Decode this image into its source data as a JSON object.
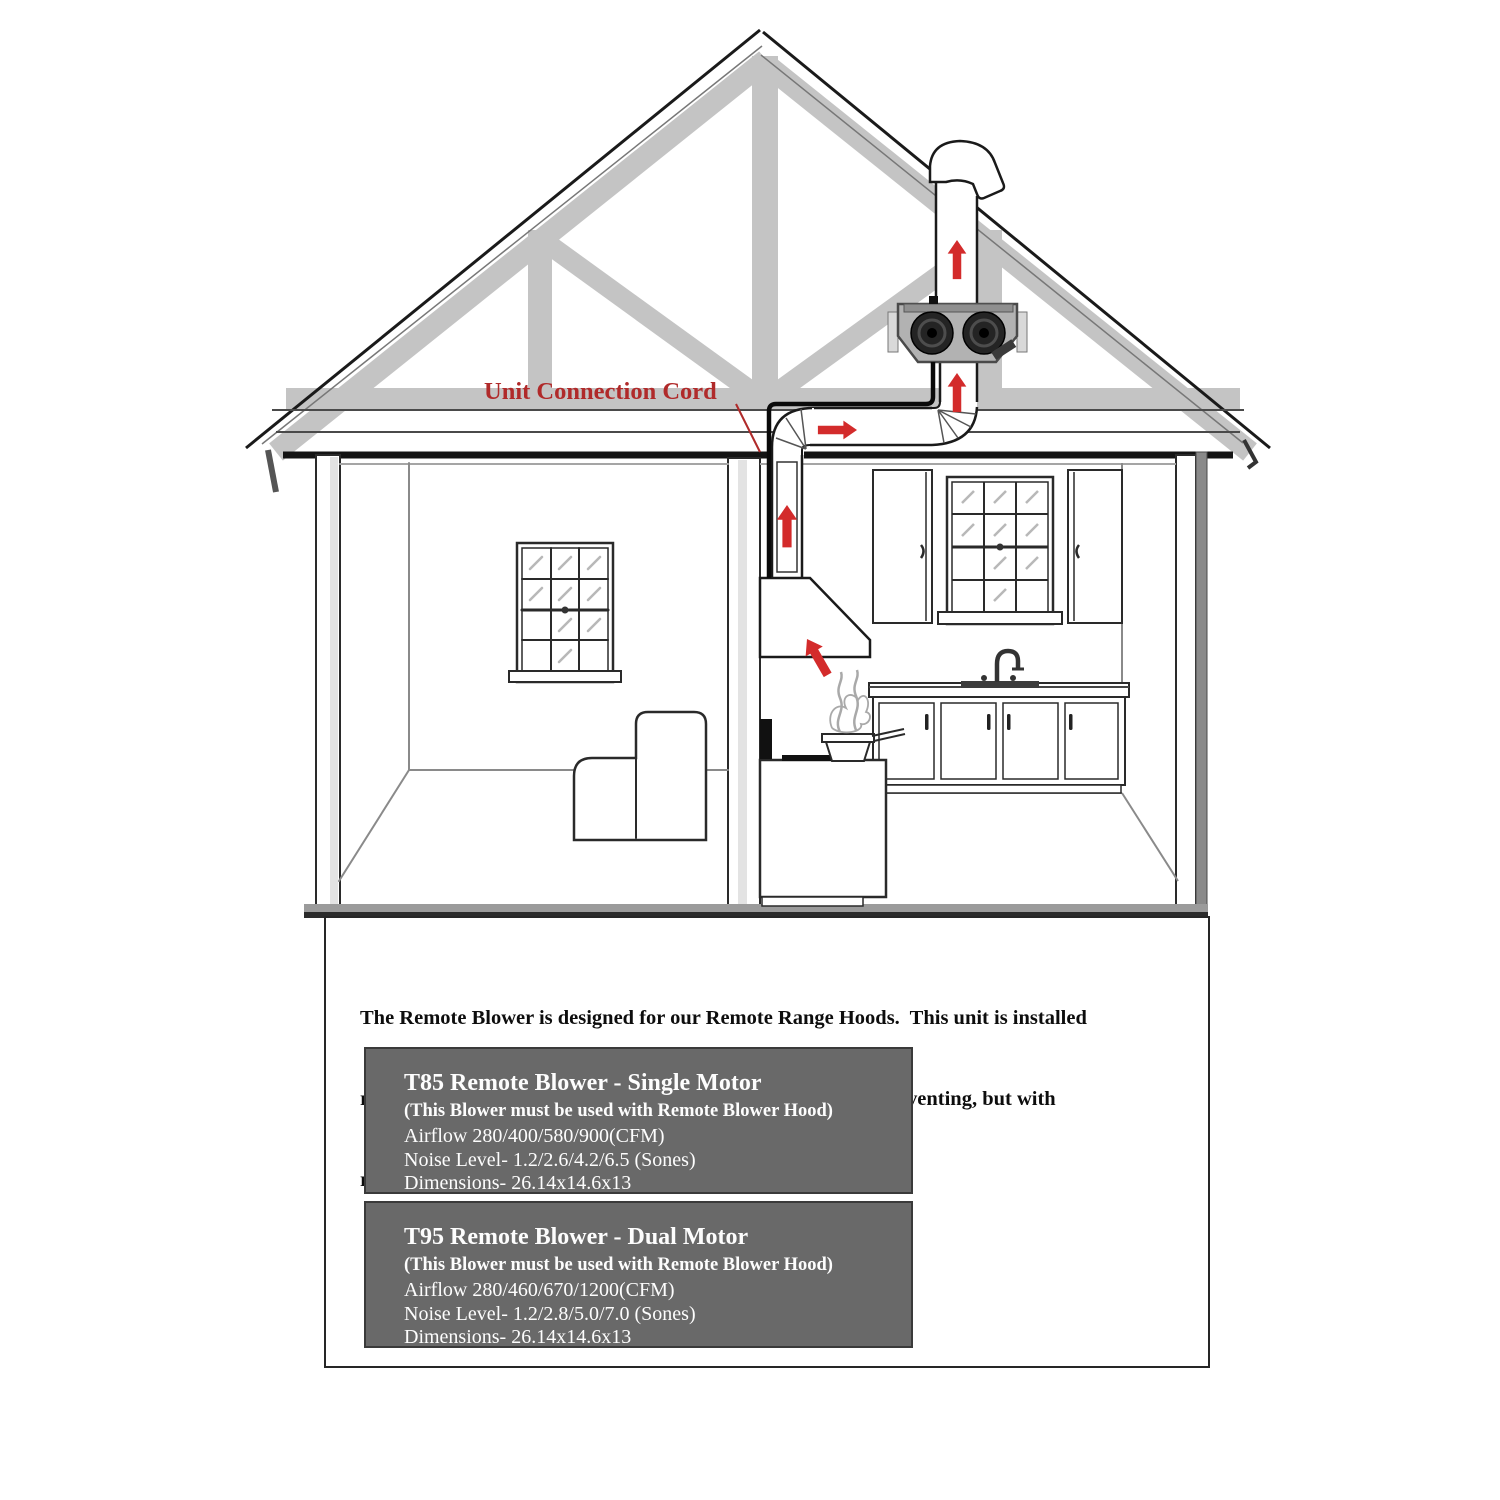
{
  "diagram": {
    "label_unit_connection_cord": "Unit Connection Cord",
    "airflow_arrow_count": 5,
    "scene": "cutaway house showing remote blower installed in attic, ducted from kitchen range hood through roof vent",
    "colors": {
      "arrow_red": "#d32b2b",
      "label_red": "#b02a2a",
      "truss_gray": "#c4c4c4",
      "blower_body_gray": "#b2b2b2",
      "blower_motor_dark": "#1f1f1f",
      "cord_black": "#0a0a0a",
      "spec_box_gray": "#696969",
      "spec_box_text": "#ffffff"
    }
  },
  "description": {
    "lines": [
      "The Remote Blower is designed for our Remote Range Hoods.  This unit is installed",
      "remotely in the interior of your home.  This provides powerful venting, but with",
      "reduced noise."
    ]
  },
  "products": [
    {
      "title": "T85 Remote Blower - Single Motor",
      "note": "(This Blower must be used with Remote Blower Hood)",
      "airflow": "Airflow 280/400/580/900(CFM)",
      "noise_level": "Noise Level- 1.2/2.6/4.2/6.5 (Sones)",
      "dimensions": "Dimensions- 26.14x14.6x13"
    },
    {
      "title": "T95 Remote Blower - Dual Motor",
      "note": "(This Blower must be used with Remote Blower Hood)",
      "airflow": "Airflow 280/460/670/1200(CFM)",
      "noise_level": "Noise Level- 1.2/2.8/5.0/7.0 (Sones)",
      "dimensions": "Dimensions- 26.14x14.6x13"
    }
  ]
}
